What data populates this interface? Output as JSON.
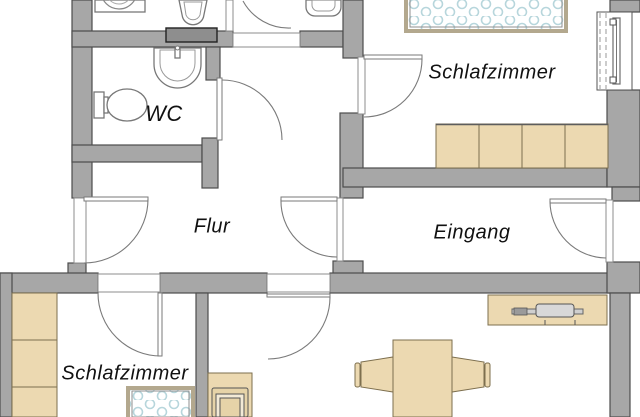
{
  "rooms": {
    "bedroom_top": {
      "label": "Schlafzimmer"
    },
    "wc": {
      "label": "WC"
    },
    "hall": {
      "label": "Flur"
    },
    "entrance": {
      "label": "Eingang"
    },
    "bedroom_bottom": {
      "label": "Schlafzimmer"
    }
  },
  "colors": {
    "bg": "#ffffff",
    "wall": "#a7a7a7",
    "wall-outline": "#4d4d4d",
    "furniture": "#ecd9b1",
    "furniture-outline": "#7d6f4e",
    "bed-dot": "#b7d6dc",
    "label": "#111111"
  }
}
